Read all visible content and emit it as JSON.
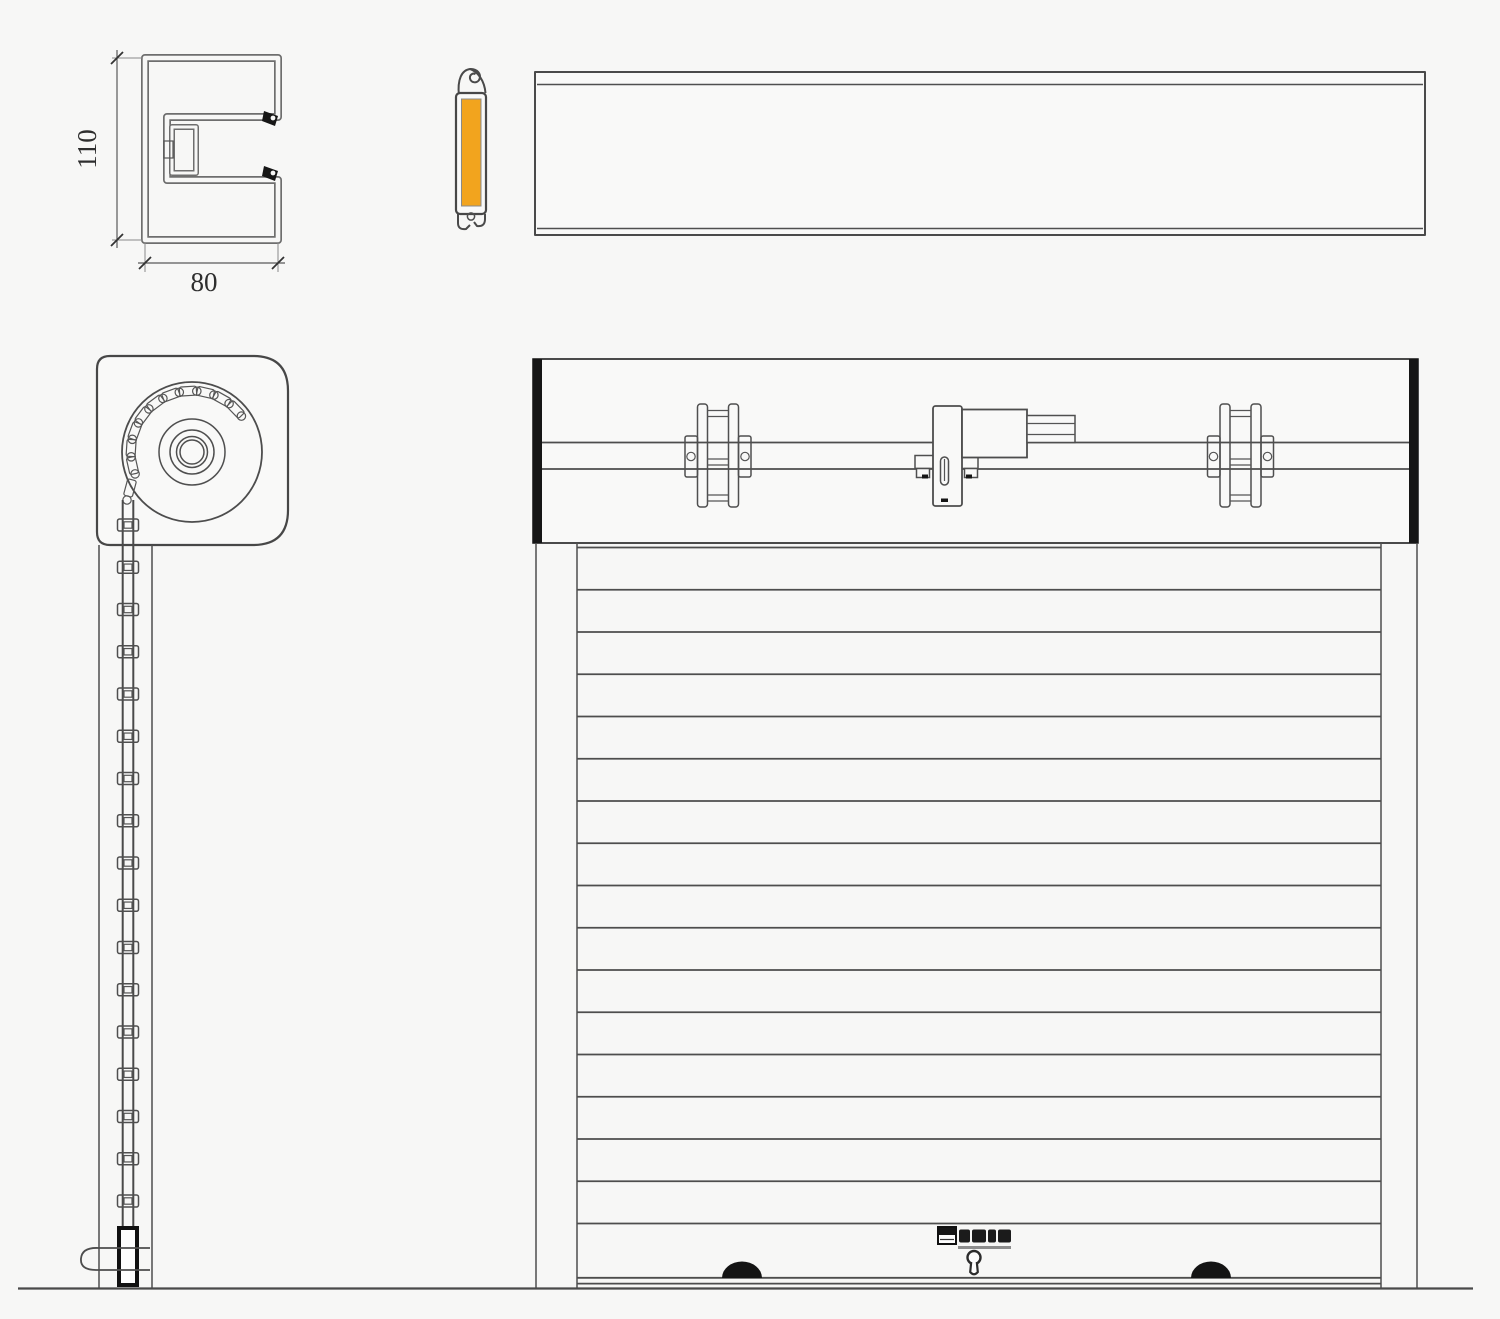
{
  "drawing": {
    "background": "#f7f7f6",
    "line_color": "#4a4a4a",
    "endplate_color": "#161616",
    "handle_color": "#141414",
    "insulation_color": "#F2A41E"
  },
  "rail_section": {
    "height_label": "110",
    "width_label": "80"
  },
  "front_view": {
    "slat_count": 17,
    "icons": {
      "keyhole": "keyhole-icon",
      "left_handle": "handle-dome-icon",
      "right_handle": "handle-dome-icon",
      "brand": "brand-logo"
    }
  },
  "side_view": {
    "curtain_joint_count": 17,
    "roll_segment_count": 10,
    "roll_radii": [
      70,
      33,
      22,
      15.5,
      12
    ]
  }
}
